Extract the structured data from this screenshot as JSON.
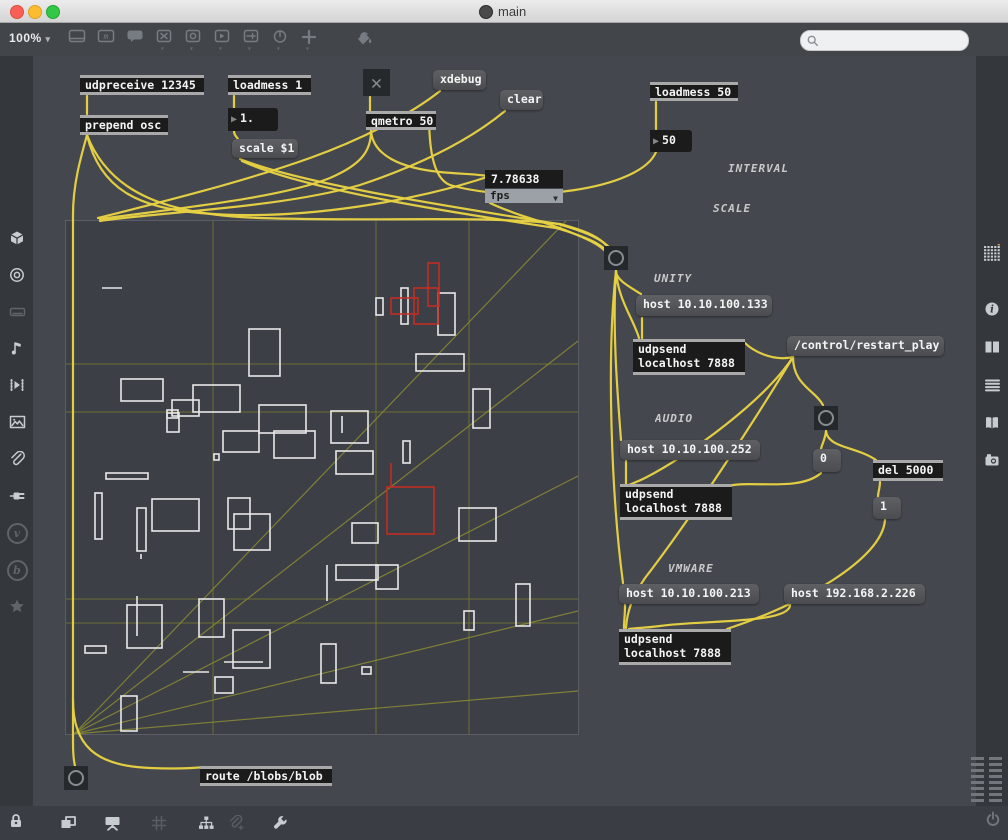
{
  "window": {
    "title": "main"
  },
  "toolbar": {
    "zoom_level": "100%",
    "icons": [
      {
        "name": "object-box-icon",
        "kind": "window",
        "caret": false
      },
      {
        "name": "message-box-icon",
        "kind": "mbox",
        "caret": false
      },
      {
        "name": "comment-icon",
        "kind": "bubble",
        "caret": false
      },
      {
        "name": "toggle-icon",
        "kind": "xbox",
        "caret": true
      },
      {
        "name": "button-icon",
        "kind": "obox",
        "caret": true
      },
      {
        "name": "playbar-icon",
        "kind": "pbox",
        "caret": true
      },
      {
        "name": "slider-icon",
        "kind": "sbox",
        "caret": true
      },
      {
        "name": "dial-icon",
        "kind": "dial",
        "caret": true
      },
      {
        "name": "plus-icon",
        "kind": "plus",
        "caret": true
      },
      {
        "name": "paint-bucket-icon",
        "kind": "bucket",
        "caret": false,
        "gap": true
      }
    ]
  },
  "search": {
    "placeholder": "",
    "value": ""
  },
  "left_sidebar": {
    "icons": [
      {
        "name": "cube-icon",
        "kind": "cube",
        "y": 226
      },
      {
        "name": "target-icon",
        "kind": "target",
        "y": 263
      },
      {
        "name": "keyboard-icon",
        "kind": "keyboard",
        "y": 300,
        "dim": true
      },
      {
        "name": "music-note-icon",
        "kind": "note",
        "y": 336
      },
      {
        "name": "sequencer-icon",
        "kind": "sequencer",
        "y": 373
      },
      {
        "name": "image-icon",
        "kind": "image",
        "y": 410
      },
      {
        "name": "paperclip-icon",
        "kind": "clip",
        "y": 447
      },
      {
        "name": "plug-icon",
        "kind": "plug",
        "y": 484
      },
      {
        "name": "vimeo-icon",
        "kind": "vcirc",
        "y": 521,
        "dim": true,
        "glyph": "v"
      },
      {
        "name": "beap-icon",
        "kind": "vcirc",
        "y": 558,
        "dim": true,
        "glyph": "b"
      },
      {
        "name": "star-icon",
        "kind": "star",
        "y": 594,
        "dim": true
      }
    ]
  },
  "right_sidebar": {
    "icons": [
      {
        "name": "object-browser-icon",
        "kind": "dotgrid",
        "y": 241
      },
      {
        "name": "info-icon",
        "kind": "info",
        "y": 297
      },
      {
        "name": "inspector-icon",
        "kind": "panels",
        "y": 335
      },
      {
        "name": "console-icon",
        "kind": "listlines",
        "y": 373
      },
      {
        "name": "reference-icon",
        "kind": "book",
        "y": 411
      },
      {
        "name": "snapshot-icon",
        "kind": "camera",
        "y": 448
      }
    ]
  },
  "bottom_bar": {
    "icons": [
      {
        "name": "layers-icon",
        "kind": "layers",
        "x": 56
      },
      {
        "name": "presentation-icon",
        "kind": "presentation",
        "x": 100
      },
      {
        "name": "grid-icon",
        "kind": "gridlines",
        "x": 147,
        "dim": true
      },
      {
        "name": "hierarchy-icon",
        "kind": "tree",
        "x": 194
      },
      {
        "name": "paperclip-plus-icon",
        "kind": "clipplus",
        "x": 224,
        "dim": true
      },
      {
        "name": "wrench-icon",
        "kind": "wrench",
        "x": 268
      }
    ]
  },
  "colors": {
    "cord_yellow": "#e7d243",
    "canvas_line_olive": "#8b8b33",
    "grid_olive": "#73732f",
    "blob_white": "#e8e8e8",
    "blob_red": "#cc2a20",
    "accent_orange": "#d98e3f"
  },
  "patch": {
    "objects": [
      {
        "name": "udpreceive-object",
        "type": "object",
        "text": "udpreceive 12345",
        "x": 80,
        "y": 75,
        "w": 124,
        "h": 20
      },
      {
        "name": "prepend-osc-object",
        "type": "object",
        "text": "prepend osc",
        "x": 80,
        "y": 115,
        "w": 88,
        "h": 20
      },
      {
        "name": "loadmess-1-object",
        "type": "object",
        "text": "loadmess 1",
        "x": 228,
        "y": 75,
        "w": 83,
        "h": 20
      },
      {
        "name": "float-number-box",
        "type": "number",
        "text": "1.",
        "x": 228,
        "y": 108,
        "w": 50,
        "h": 23
      },
      {
        "name": "scale-message",
        "type": "message",
        "text": "scale $1",
        "x": 232,
        "y": 139,
        "w": 66,
        "h": 19
      },
      {
        "name": "toggle-x",
        "type": "toggle",
        "text": "✕",
        "x": 363,
        "y": 69,
        "w": 27,
        "h": 27
      },
      {
        "name": "qmetro-object",
        "type": "object",
        "text": "qmetro 50",
        "x": 366,
        "y": 111,
        "w": 70,
        "h": 19
      },
      {
        "name": "xdebug-message",
        "type": "message",
        "text": "xdebug",
        "x": 433,
        "y": 70,
        "w": 53,
        "h": 20
      },
      {
        "name": "clear-message",
        "type": "message",
        "text": "clear",
        "x": 500,
        "y": 90,
        "w": 43,
        "h": 20
      },
      {
        "name": "loadmess-50-object",
        "type": "object",
        "text": "loadmess 50",
        "x": 650,
        "y": 82,
        "w": 88,
        "h": 19
      },
      {
        "name": "int-number-box",
        "type": "number",
        "text": "50",
        "x": 650,
        "y": 130,
        "w": 42,
        "h": 22
      },
      {
        "name": "fps-number-display",
        "type": "numdisplay",
        "text": "7.78638",
        "x": 485,
        "y": 170,
        "w": 78,
        "h": 18
      },
      {
        "name": "fps-menu",
        "type": "umenu",
        "text": "fps",
        "x": 485,
        "y": 189,
        "w": 78,
        "h": 14
      },
      {
        "name": "interval-comment",
        "type": "comment",
        "text": "INTERVAL",
        "x": 728,
        "y": 162,
        "w": 70,
        "h": 14
      },
      {
        "name": "scale-comment",
        "type": "comment",
        "text": "SCALE",
        "x": 713,
        "y": 202,
        "w": 50,
        "h": 14
      },
      {
        "name": "bang-button-main",
        "type": "button",
        "text": "",
        "x": 604,
        "y": 246,
        "w": 24,
        "h": 24
      },
      {
        "name": "unity-comment",
        "type": "comment",
        "text": "UNITY",
        "x": 654,
        "y": 272,
        "w": 46,
        "h": 14
      },
      {
        "name": "host-unity-message",
        "type": "message",
        "text": "host 10.10.100.133",
        "x": 636,
        "y": 295,
        "w": 136,
        "h": 21
      },
      {
        "name": "udpsend-unity-object",
        "type": "object",
        "text": "udpsend\nlocalhost 7888",
        "x": 633,
        "y": 339,
        "w": 112,
        "h": 36
      },
      {
        "name": "restart-play-message",
        "type": "message",
        "text": "/control/restart_play",
        "x": 787,
        "y": 336,
        "w": 157,
        "h": 20
      },
      {
        "name": "audio-comment",
        "type": "comment",
        "text": "AUDIO",
        "x": 655,
        "y": 412,
        "w": 46,
        "h": 14
      },
      {
        "name": "host-audio-message",
        "type": "message",
        "text": "host 10.10.100.252",
        "x": 620,
        "y": 440,
        "w": 140,
        "h": 20
      },
      {
        "name": "udpsend-audio-object",
        "type": "object",
        "text": "udpsend\nlocalhost 7888",
        "x": 620,
        "y": 484,
        "w": 112,
        "h": 36
      },
      {
        "name": "bang-button-audio",
        "type": "button",
        "text": "",
        "x": 814,
        "y": 406,
        "w": 24,
        "h": 24
      },
      {
        "name": "zero-message",
        "type": "message",
        "text": "0",
        "x": 813,
        "y": 449,
        "w": 28,
        "h": 23
      },
      {
        "name": "del-5000-object",
        "type": "object",
        "text": "del 5000",
        "x": 873,
        "y": 460,
        "w": 70,
        "h": 21
      },
      {
        "name": "one-message",
        "type": "message",
        "text": "1",
        "x": 873,
        "y": 497,
        "w": 28,
        "h": 22
      },
      {
        "name": "vmware-comment",
        "type": "comment",
        "text": "VMWARE",
        "x": 668,
        "y": 562,
        "w": 54,
        "h": 14
      },
      {
        "name": "host-vmware-message",
        "type": "message",
        "text": "host 10.10.100.213",
        "x": 619,
        "y": 584,
        "w": 140,
        "h": 20
      },
      {
        "name": "host-vmware2-message",
        "type": "message",
        "text": "host 192.168.2.226",
        "x": 784,
        "y": 584,
        "w": 141,
        "h": 20
      },
      {
        "name": "udpsend-vmware-object",
        "type": "object",
        "text": "udpsend\nlocalhost 7888",
        "x": 619,
        "y": 629,
        "w": 112,
        "h": 36
      },
      {
        "name": "bang-button-bottom",
        "type": "button",
        "text": "",
        "x": 64,
        "y": 766,
        "w": 24,
        "h": 24
      },
      {
        "name": "route-blobs-object",
        "type": "object",
        "text": "route /blobs/blob",
        "x": 200,
        "y": 766,
        "w": 132,
        "h": 20
      }
    ],
    "cords": [
      "M87,96 L87,114",
      "M234,96 L234,108",
      "M234,131 C234,135 236,136 238,139",
      "M370,97 L370,111",
      "M656,102 L656,129",
      "M87,135 C80,160 73,185 73,215 L73,742 C73,756 74,762 75,766",
      "M73,700 C73,745 95,766 150,768 C175,769 195,768 205,767",
      "M87,135 C100,190 140,208 200,213 C300,222 420,200 490,176",
      "M87,135 C110,195 170,215 260,218 C380,222 480,215 560,224 C590,232 600,238 608,247",
      "M240,159 C300,184 460,208 558,224 C592,234 602,240 610,248",
      "M242,161 C305,190 455,213 556,228 C590,238 600,244 607,251",
      "M371,131 C371,152 360,165 330,178 C280,198 180,208 100,219",
      "M371,131 C373,155 400,168 440,172 C460,174 475,174 488,176",
      "M656,152 C640,190 520,205 450,185 C432,178 429,145 429,113",
      "M440,91 C410,115 360,140 310,158 C240,183 150,205 98,218",
      "M505,111 C470,140 420,165 360,185 C280,208 160,212 100,221",
      "M490,203 C515,215 545,222 565,230 C590,240 600,245 606,252",
      "M616,271 C616,280 630,287 641,294",
      "M616,271 C618,300 634,320 639,338",
      "M616,271 C612,330 618,400 621,440",
      "M616,271 C606,360 612,500 623,583",
      "M642,318 L642,338",
      "M793,357 C772,362 752,350 745,343",
      "M793,357 C793,385 815,390 823,405",
      "M793,357 C765,400 690,455 645,478 C635,483 630,484 627,486",
      "M793,357 C755,420 690,520 645,578 C632,597 627,612 626,628",
      "M826,431 C825,440 822,444 821,449",
      "M826,431 C828,448 855,446 876,460",
      "M880,482 C880,488 878,492 878,497",
      "M821,473 C800,492 750,480 728,486",
      "M885,520 C882,560 800,605 727,629",
      "M626,461 C626,470 626,477 626,484",
      "M625,605 C625,615 624,621 624,628",
      "M790,605 C790,624 700,620 660,626 C645,628 635,628 629,629"
    ],
    "canvas": {
      "x": 65,
      "y": 220,
      "w": 512,
      "h": 513,
      "grid_v": [
        147,
        310,
        403
      ],
      "grid_h": [
        143,
        191,
        378,
        402
      ],
      "fan_lines": [
        [
          8,
          513,
          500,
          0
        ],
        [
          8,
          513,
          512,
          120
        ],
        [
          8,
          513,
          512,
          255
        ],
        [
          8,
          513,
          512,
          390
        ],
        [
          8,
          513,
          512,
          470
        ]
      ],
      "rects_white": [
        [
          310,
          77,
          7,
          17
        ],
        [
          335,
          67,
          7,
          36
        ],
        [
          372,
          72,
          17,
          42
        ],
        [
          183,
          108,
          31,
          47
        ],
        [
          350,
          133,
          48,
          17
        ],
        [
          55,
          158,
          42,
          22
        ],
        [
          127,
          164,
          47,
          27
        ],
        [
          106,
          179,
          27,
          16
        ],
        [
          101,
          189,
          11,
          8
        ],
        [
          101,
          192,
          12,
          19
        ],
        [
          193,
          184,
          47,
          28
        ],
        [
          157,
          210,
          36,
          21
        ],
        [
          208,
          210,
          41,
          27
        ],
        [
          265,
          190,
          37,
          32
        ],
        [
          270,
          230,
          37,
          23
        ],
        [
          337,
          220,
          7,
          22
        ],
        [
          407,
          168,
          17,
          39
        ],
        [
          148,
          233,
          5,
          6
        ],
        [
          40,
          252,
          42,
          6
        ],
        [
          29,
          272,
          7,
          46
        ],
        [
          71,
          287,
          9,
          43
        ],
        [
          86,
          278,
          47,
          32
        ],
        [
          162,
          277,
          22,
          31
        ],
        [
          168,
          293,
          36,
          36
        ],
        [
          286,
          302,
          26,
          20
        ],
        [
          393,
          287,
          37,
          33
        ],
        [
          270,
          344,
          42,
          15
        ],
        [
          310,
          344,
          22,
          24
        ],
        [
          450,
          363,
          14,
          42
        ],
        [
          398,
          390,
          10,
          19
        ],
        [
          61,
          384,
          35,
          43
        ],
        [
          133,
          378,
          25,
          38
        ],
        [
          19,
          425,
          21,
          7
        ],
        [
          167,
          409,
          37,
          38
        ],
        [
          149,
          456,
          18,
          16
        ],
        [
          255,
          423,
          15,
          39
        ],
        [
          296,
          446,
          9,
          7
        ],
        [
          55,
          475,
          16,
          35
        ]
      ],
      "lines_white": [
        [
          36,
          67,
          56,
          67
        ],
        [
          276,
          195,
          276,
          212
        ],
        [
          75,
          333,
          75,
          338
        ],
        [
          261,
          344,
          261,
          380
        ],
        [
          158,
          441,
          197,
          441
        ],
        [
          117,
          451,
          143,
          451
        ],
        [
          71,
          375,
          71,
          415
        ]
      ],
      "rects_red": [
        [
          362,
          42,
          11,
          43
        ],
        [
          348,
          67,
          24,
          36
        ],
        [
          325,
          77,
          27,
          16
        ],
        [
          321,
          266,
          47,
          47
        ]
      ],
      "lines_red": [
        [
          325,
          242,
          325,
          266
        ]
      ]
    }
  }
}
